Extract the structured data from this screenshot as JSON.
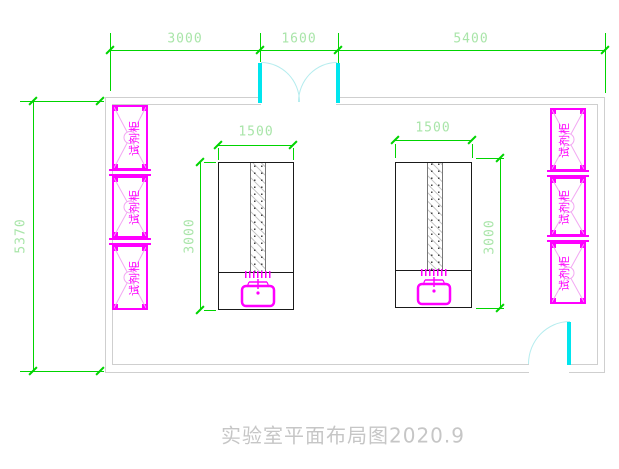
{
  "title": {
    "text": "实验室平面布局图2020.9"
  },
  "dims": {
    "top_left": "3000",
    "top_middle": "1600",
    "top_right": "5400",
    "wall_left": "5370",
    "table_width": "1500",
    "table_height": "3000"
  },
  "cabinets": {
    "label": "试剂柜"
  },
  "colors": {
    "dimension": "#00d400",
    "dimension_text": "#a9e5a9",
    "wall": "#cfcfcf",
    "cabinet": "#ff00ff",
    "cabinet_light": "#f2a8f2",
    "door": "#00e5ee",
    "door_arc": "#b4ecee",
    "table_outline": "#1a1a1a",
    "sink": "#ff00ff",
    "title_text": "#c6c6c6"
  }
}
